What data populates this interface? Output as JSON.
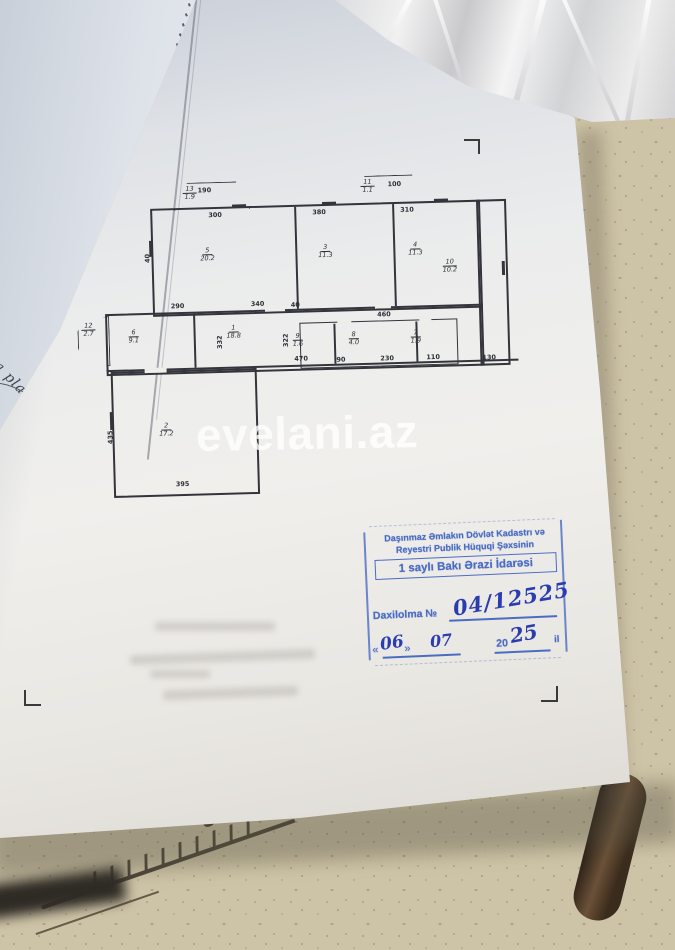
{
  "watermark": {
    "text": "evelani.az"
  },
  "under_page": {
    "side_text": "iya planı"
  },
  "desk": {
    "ruler_label": "300"
  },
  "floorplan": {
    "rooms": [
      {
        "number": "5",
        "area": "20.2"
      },
      {
        "number": "3",
        "area": "11.3"
      },
      {
        "number": "4",
        "area": "11.3"
      },
      {
        "number": "6",
        "area": "9.1"
      },
      {
        "number": "1",
        "area": "18.8"
      },
      {
        "number": "9",
        "area": "1.6"
      },
      {
        "number": "8",
        "area": "4.0"
      },
      {
        "number": "7",
        "area": "1.9"
      },
      {
        "number": "2",
        "area": "17.2"
      },
      {
        "number": "10",
        "area": "10.2"
      },
      {
        "number": "13",
        "area": "1.9"
      },
      {
        "number": "11",
        "area": "1.1"
      },
      {
        "number": "12",
        "area": "2.7"
      }
    ],
    "dimensions": [
      "190",
      "300",
      "380",
      "310",
      "100",
      "40",
      "290",
      "340",
      "40",
      "460",
      "332",
      "322",
      "470",
      "90",
      "230",
      "110",
      "130",
      "435",
      "395"
    ]
  },
  "stamp": {
    "org_line1": "Daşınmaz Əmlakın Dövlət Kadastrı və",
    "org_line2": "Reyestri Publik Hüquqi Şəxsinin",
    "office_line": "1 saylı Bakı Ərazi İdarəsi",
    "entry_label": "Daxilolma №",
    "entry_number": "04/12525",
    "quote_open": "«",
    "quote_close": "»",
    "day": "06",
    "month": "07",
    "year_prefix": "20",
    "year_written": "25",
    "year_suffix": "il"
  }
}
